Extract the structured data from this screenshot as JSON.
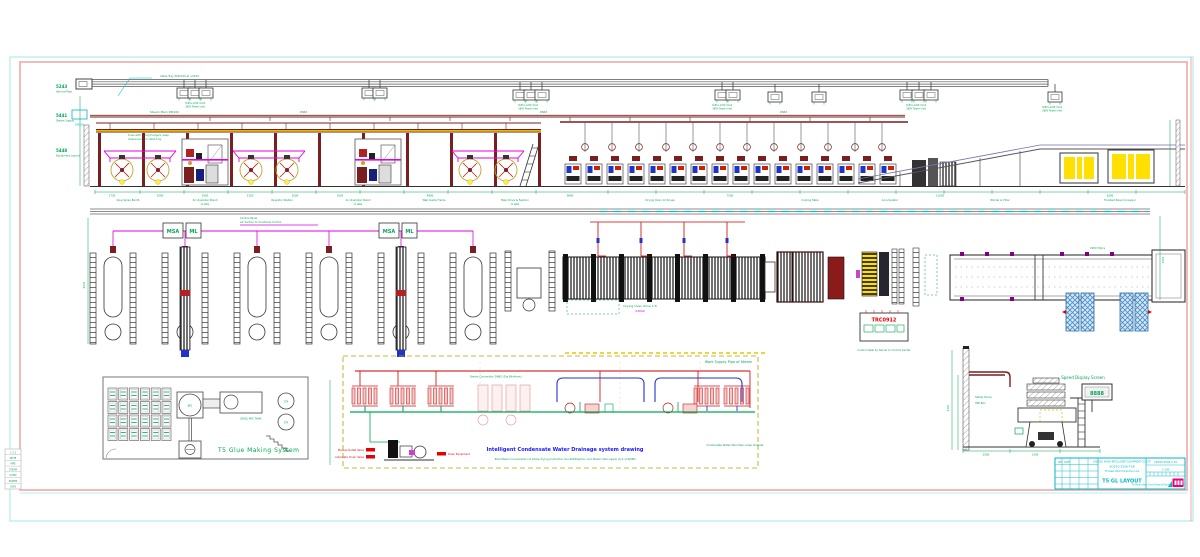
{
  "margins": {
    "levels": [
      {
        "code": "5243",
        "label": "Service Pipe"
      },
      {
        "code": "5441",
        "label": "Steam Supply"
      },
      {
        "code": "5448",
        "label": "Equipment Layout"
      }
    ],
    "steam_tag": "DN100",
    "note_1": "Overhead steam pipe fixed on roof",
    "note_2": "truss with spring hangers, keep",
    "note_3": "clearance from cable tray"
  },
  "top_band": {
    "tray_label": "Cable Tray 400x150 at +5243",
    "jbox_label": "3x95+1x50 mm2",
    "jbox_sub": "380V Power Inlet",
    "steam_label": "Steam Main DN100",
    "steam_branch": "DN65",
    "captions": [
      "Glue Spray Booth",
      "2x Unwinder Stand",
      "Operator Station",
      "2x Unwinder Stand",
      "Web Guide Frame",
      "Main Drive & Festoon",
      "Drying Oven 12 Zones",
      "Cooling Table",
      "Accumulator",
      "Winder & Tilter",
      "Finished Panel Conveyor"
    ],
    "dims": [
      "1730",
      "3500",
      "3500",
      "2150",
      "3500",
      "3500",
      "4800",
      "9600",
      "7500",
      "11000",
      "6200"
    ],
    "sets_note": "(2 sets)"
  },
  "mid_band": {
    "box_label_1": "MSA",
    "box_label_2": "ML",
    "control_note_1": "Control Panel",
    "control_note_2": "Air Suction to Condense Control",
    "oven_label": "Drying Oven Zone 1-8",
    "oven_dim": "24000",
    "conveyor_label": "1950 T2pcs",
    "trc_code": "TRC0912",
    "trc_note": "Control Desk by Server to Control Center",
    "side_dim": "2500",
    "left_dim": "6000"
  },
  "glue_room": {
    "title": "T5 Glue Making System",
    "tank_label": "JRG",
    "mixer_label": "2000L MIX TANK",
    "tank2_label": "GTK",
    "tank3_label": "STR"
  },
  "schematic": {
    "top_label": "Work Supply Pipe of Steam",
    "branch_label": "Steam Connection DN65 (Dia 89x4mm)",
    "title": "Intelligent Condensate Water Drainage system drawing",
    "caption": "Total Steam Consumption of whole drying production line 4000kg/hour and Steam Inlet supply (0.4~0.6)MPa",
    "right_label": "Condensate Water Main Pipe Lower Drainlet",
    "valve_1": "Manual Outlet Valve",
    "valve_2": "Automatic Drain Valve",
    "valve_3": "Drain Equipment"
  },
  "speed_display": {
    "label": "Speed Display Screen",
    "readout": "8888",
    "note_1": "Safety Fence",
    "note_2": "HMI Box",
    "dim_1": "2500",
    "dim_2": "3100"
  },
  "title_block": {
    "company": "JIANGSU XINDA INTELLIGENT EQUIPMENT CO.,LTD",
    "project": "XD250-2506-TSB",
    "subtitle": "T5 Glass Wool Production Line",
    "drawing_title": "T5 GL LAYOUT",
    "drawing_no": "XD250-2506-2-01",
    "scale": "1:100",
    "footer": "T5 Production Line General Equipment Layout",
    "rev": "REV",
    "date": "DATE",
    "logo": "XD"
  },
  "legend_table": {
    "rows": [
      "1 2 3",
      "NOTE",
      "PIPE",
      "STEAM",
      "COND",
      "POWER",
      "SIGN"
    ]
  },
  "colors": {
    "frame_outer": "#9fe8e8",
    "frame_inner": "#f2a9a9",
    "green": "#00a651",
    "magenta": "#e000e0",
    "maroon": "#7a1f1f",
    "yellow": "#ffe000",
    "cyan": "#00b7c3",
    "blue": "#1a1aff",
    "red": "#e60000",
    "hatch_blue": "#4a8cc4"
  }
}
